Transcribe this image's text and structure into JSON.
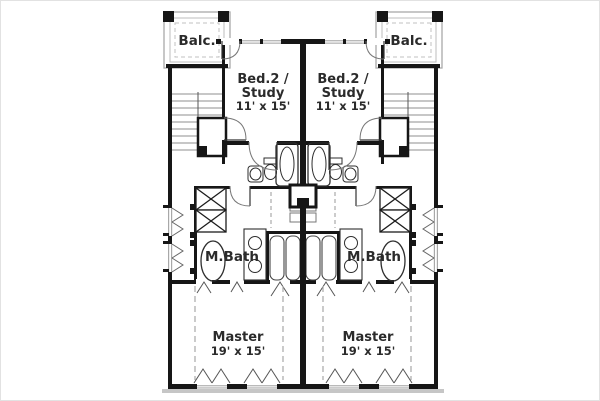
{
  "plan": {
    "kind": "duplex-upper-floor-plan",
    "colors": {
      "wall": "#161616",
      "background": "#ffffff",
      "text": "#2b2b2b",
      "window_gray": "#a8a8a8",
      "sill_band_gray": "#c6c6c6"
    },
    "rooms": {
      "balcony_left": {
        "label": "Balc."
      },
      "balcony_right": {
        "label": "Balc."
      },
      "bed2_left": {
        "name_line1": "Bed.2 /",
        "name_line2": "Study",
        "dims": "11' x 15'"
      },
      "bed2_right": {
        "name_line1": "Bed.2 /",
        "name_line2": "Study",
        "dims": "11' x 15'"
      },
      "mbath_left": {
        "label": "M.Bath"
      },
      "mbath_right": {
        "label": "M.Bath"
      },
      "master_left": {
        "name": "Master",
        "dims": "19' x 15'"
      },
      "master_right": {
        "name": "Master",
        "dims": "19' x 15'"
      }
    }
  }
}
